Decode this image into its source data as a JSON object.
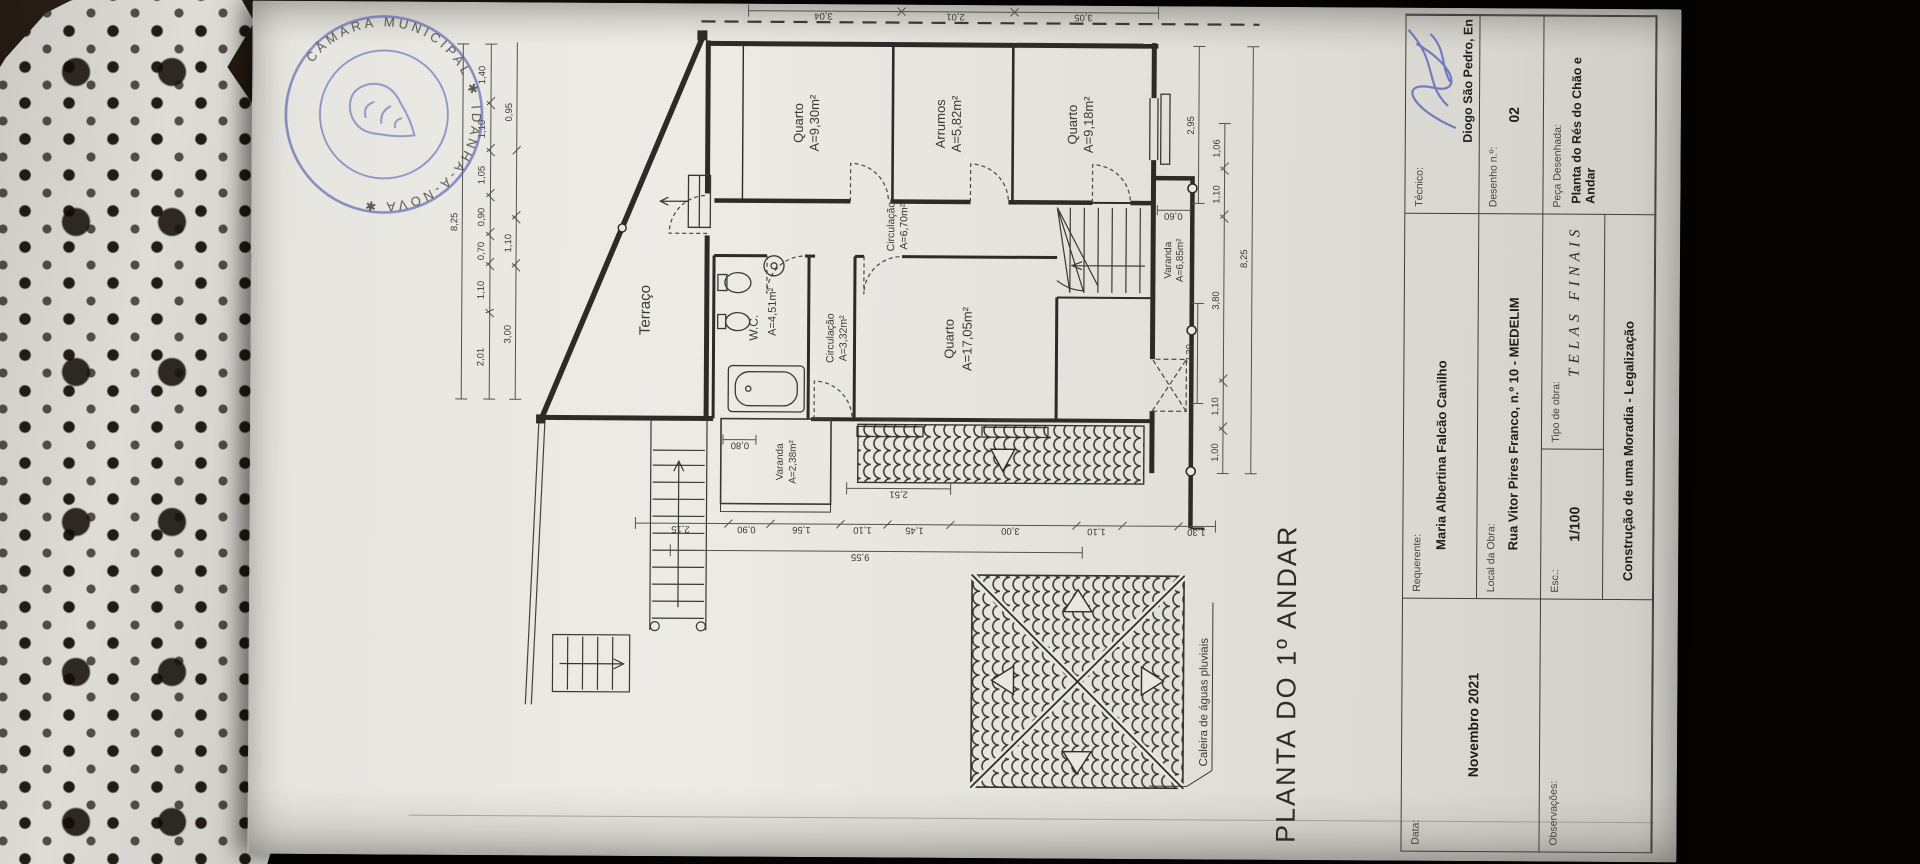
{
  "stamp": {
    "arc_text": "CÂMARA MUNICIPAL ✱ IDANHA-A-NOVA ✱",
    "color": "#5b67b4"
  },
  "drawing_title": "PLANTA DO 1º ANDAR",
  "rooms": {
    "quarto1_name": "Quarto",
    "quarto1_area": "A=9,30m²",
    "arrumos_name": "Arrumos",
    "arrumos_area": "A=5,82m²",
    "quarto2_name": "Quarto",
    "quarto2_area": "A=9,18m²",
    "circulacao1_name": "Circulação",
    "circulacao1_area": "A=6,70m²",
    "wc_name": "W.C.",
    "wc_area": "A=4,51m²",
    "circulacao2_name": "Circulação",
    "circulacao2_area": "A=3,32m²",
    "quarto3_name": "Quarto",
    "quarto3_area": "A=17,05m²",
    "terraco_name": "Terraço",
    "varanda1_name": "Varanda",
    "varanda1_area": "A=2,38m²",
    "varanda2_name": "Varanda",
    "varanda2_area": "A=6,85m²"
  },
  "annotations": {
    "caleira": "Caleira de águas pluviais"
  },
  "dims": {
    "t1": [
      "2,01",
      "1,10",
      "0,70",
      "0,90",
      "1,05",
      "1,10",
      "1,40"
    ],
    "t1_total": "8,25",
    "t2": [
      "3,00",
      "1,10",
      "0,95"
    ],
    "right": [
      "3,04",
      "2,01",
      "3,05"
    ],
    "left": [
      "2,15",
      "0,90",
      "1,56",
      "1,10",
      "1,45",
      "3,00",
      "1,10",
      "1,30"
    ],
    "left_inner": "2,51",
    "left_total": "9,55",
    "bottom": [
      "1,00",
      "1,10",
      "3,80",
      "1,10",
      "1,06"
    ],
    "bottom_inner": [
      "2,30",
      "2,95"
    ],
    "bottom_total": "8,25",
    "varanda_w": "0,60",
    "varanda1_w": "0,80"
  },
  "titleblock": {
    "data_label": "Data:",
    "data_value": "Novembro 2021",
    "observacoes_label": "Observações:",
    "requerente_label": "Requerente:",
    "requerente_value": "Maria Albertina Falcão Canilho",
    "local_label": "Local da Obra:",
    "local_value": "Rua Vitor Pires Franco, n.º 10 - MEDELIM",
    "esc_label": "Esc.:",
    "esc_value": "1/100",
    "tipo_label": "Tipo de obra:",
    "tipo_value": "TELAS FINAIS",
    "constr_value": "Construção de uma Moradia - Legalização",
    "tecnico_label": "Técnico:",
    "tecnico_value": "Diogo São Pedro, En",
    "desenho_label": "Desenho n.º:",
    "desenho_value": "02",
    "peca_label": "Peça Desenhada:",
    "peca_value_line1": "Planta do Rés do Chão e",
    "peca_value_line2": "Andar"
  }
}
